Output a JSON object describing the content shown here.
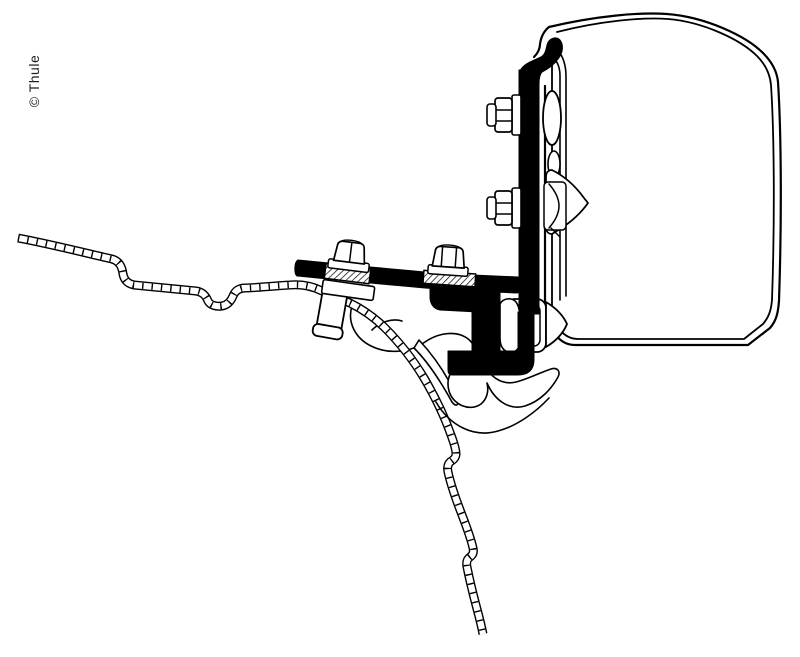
{
  "watermark": {
    "text": "© Thule"
  },
  "canvas": {
    "background": "#ffffff",
    "line_color": "#000000",
    "bracket_fill": "#000000",
    "width_px": 800,
    "height_px": 657
  },
  "diagram": {
    "type": "technical-line-drawing",
    "parts": [
      "awning-case-cross-section",
      "awning-mounting-rail",
      "adapter-bracket",
      "hex-flange-bolts",
      "roof-sheet-cross-section",
      "roof-inner-structure"
    ]
  }
}
